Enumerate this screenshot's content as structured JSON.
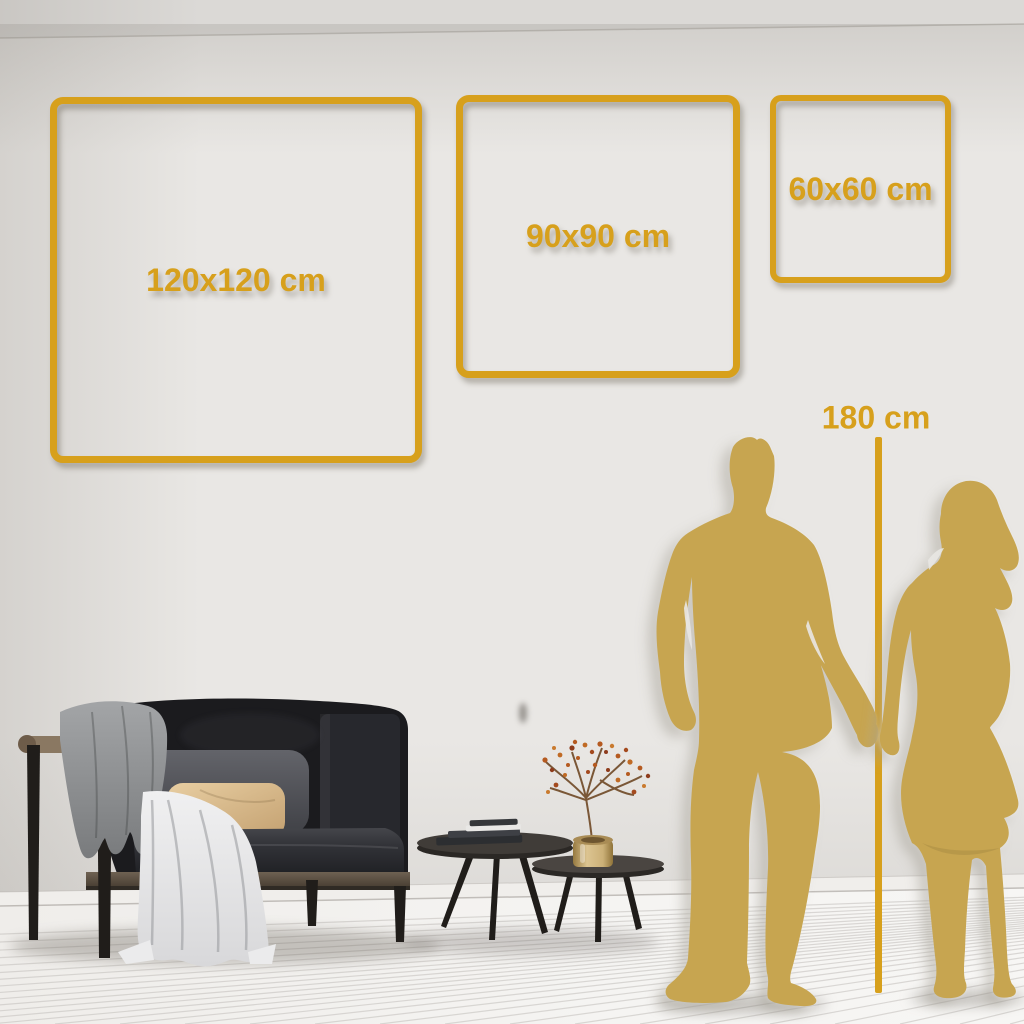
{
  "sizes": {
    "large": "120x120 cm",
    "medium": "90x90 cm",
    "small": "60x60 cm"
  },
  "height_reference": "180 cm",
  "colors": {
    "gold": "#D7A01C",
    "silhouette": "#C7A550",
    "wall": "#E9E7E4",
    "wall-top": "#DBD9D6",
    "floor": "#F4F3F1",
    "floor-line": "#C7C4C0",
    "baseboard": "#F0EEEB",
    "sofa": "#1B1B1E",
    "sofa-inner": "#27282D",
    "cushion": "#56575C",
    "pillow": "#DCBF93",
    "blanket": "#96989A",
    "cloth": "#EBEBEC",
    "wood-frame": "#5C5043",
    "wood-bar": "#8A7862",
    "table-top": "#403C38",
    "table-leg": "#201D1A",
    "vase-light": "#DCC491",
    "vase-dark": "#96793F",
    "branch": "#7A5737",
    "berry": "#B55A20"
  }
}
